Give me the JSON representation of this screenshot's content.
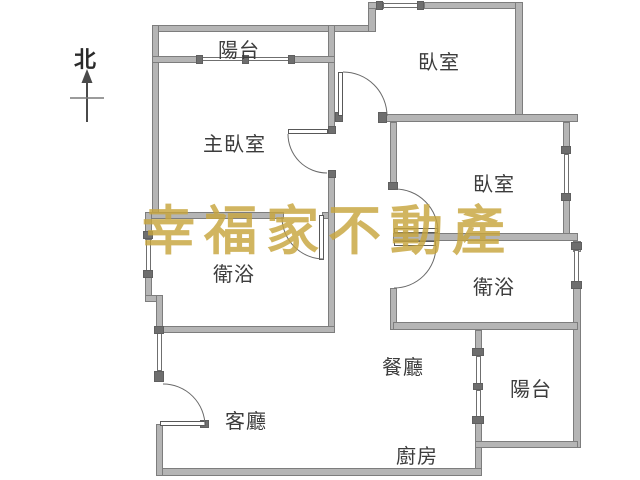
{
  "title": "apartment-floor-plan",
  "compass": {
    "north_label": "北"
  },
  "watermark": {
    "text": "幸福家不動產",
    "color": "#c8a63e"
  },
  "rooms": [
    {
      "id": "balcony-top",
      "label": "陽台"
    },
    {
      "id": "bedroom-top",
      "label": "臥室"
    },
    {
      "id": "master-bedroom",
      "label": "主臥室"
    },
    {
      "id": "bedroom-right",
      "label": "臥室"
    },
    {
      "id": "bathroom-left",
      "label": "衛浴"
    },
    {
      "id": "bathroom-right",
      "label": "衛浴"
    },
    {
      "id": "dining-room",
      "label": "餐廳"
    },
    {
      "id": "balcony-bottom",
      "label": "陽台"
    },
    {
      "id": "living-room",
      "label": "客廳"
    },
    {
      "id": "kitchen",
      "label": "廚房"
    }
  ],
  "colors": {
    "background": "#ffffff",
    "wall_fill": "#b5b5b5",
    "wall_edge": "#7d7d7d",
    "label_text": "#3c3c3c",
    "watermark_gold": "#c8a63e"
  }
}
